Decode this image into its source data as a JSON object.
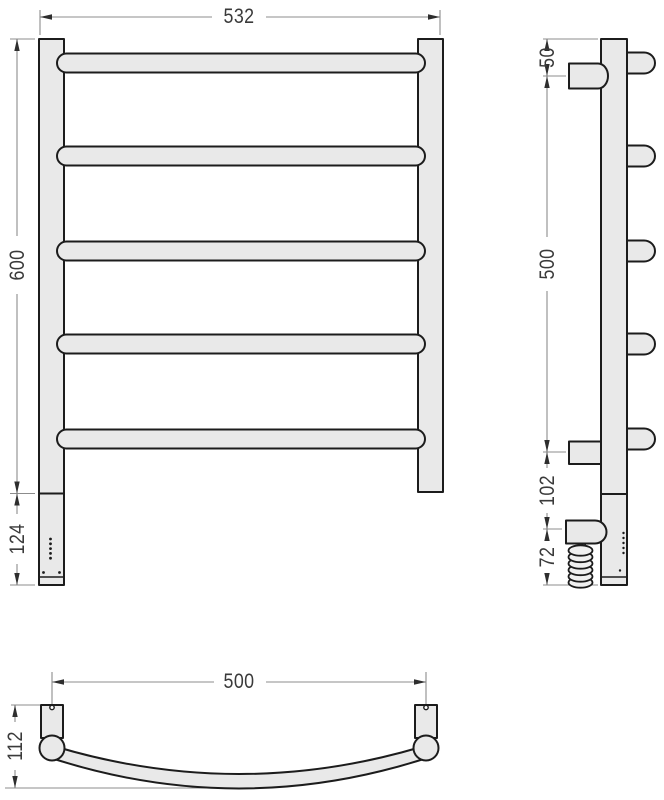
{
  "dims": {
    "front_width": "532",
    "front_height": "600",
    "front_lower": "124",
    "side_top": "50",
    "side_span": "500",
    "side_lower": "102",
    "side_cable": "72",
    "top_span": "500",
    "top_depth": "112"
  },
  "colors": {
    "background": "#ffffff",
    "outline": "#1c1c1c",
    "fill": "#e9e9e9",
    "dimension_line": "#8c8c8c",
    "arrow": "#2e2e2e",
    "dimension_text": "#3a3a3a"
  }
}
